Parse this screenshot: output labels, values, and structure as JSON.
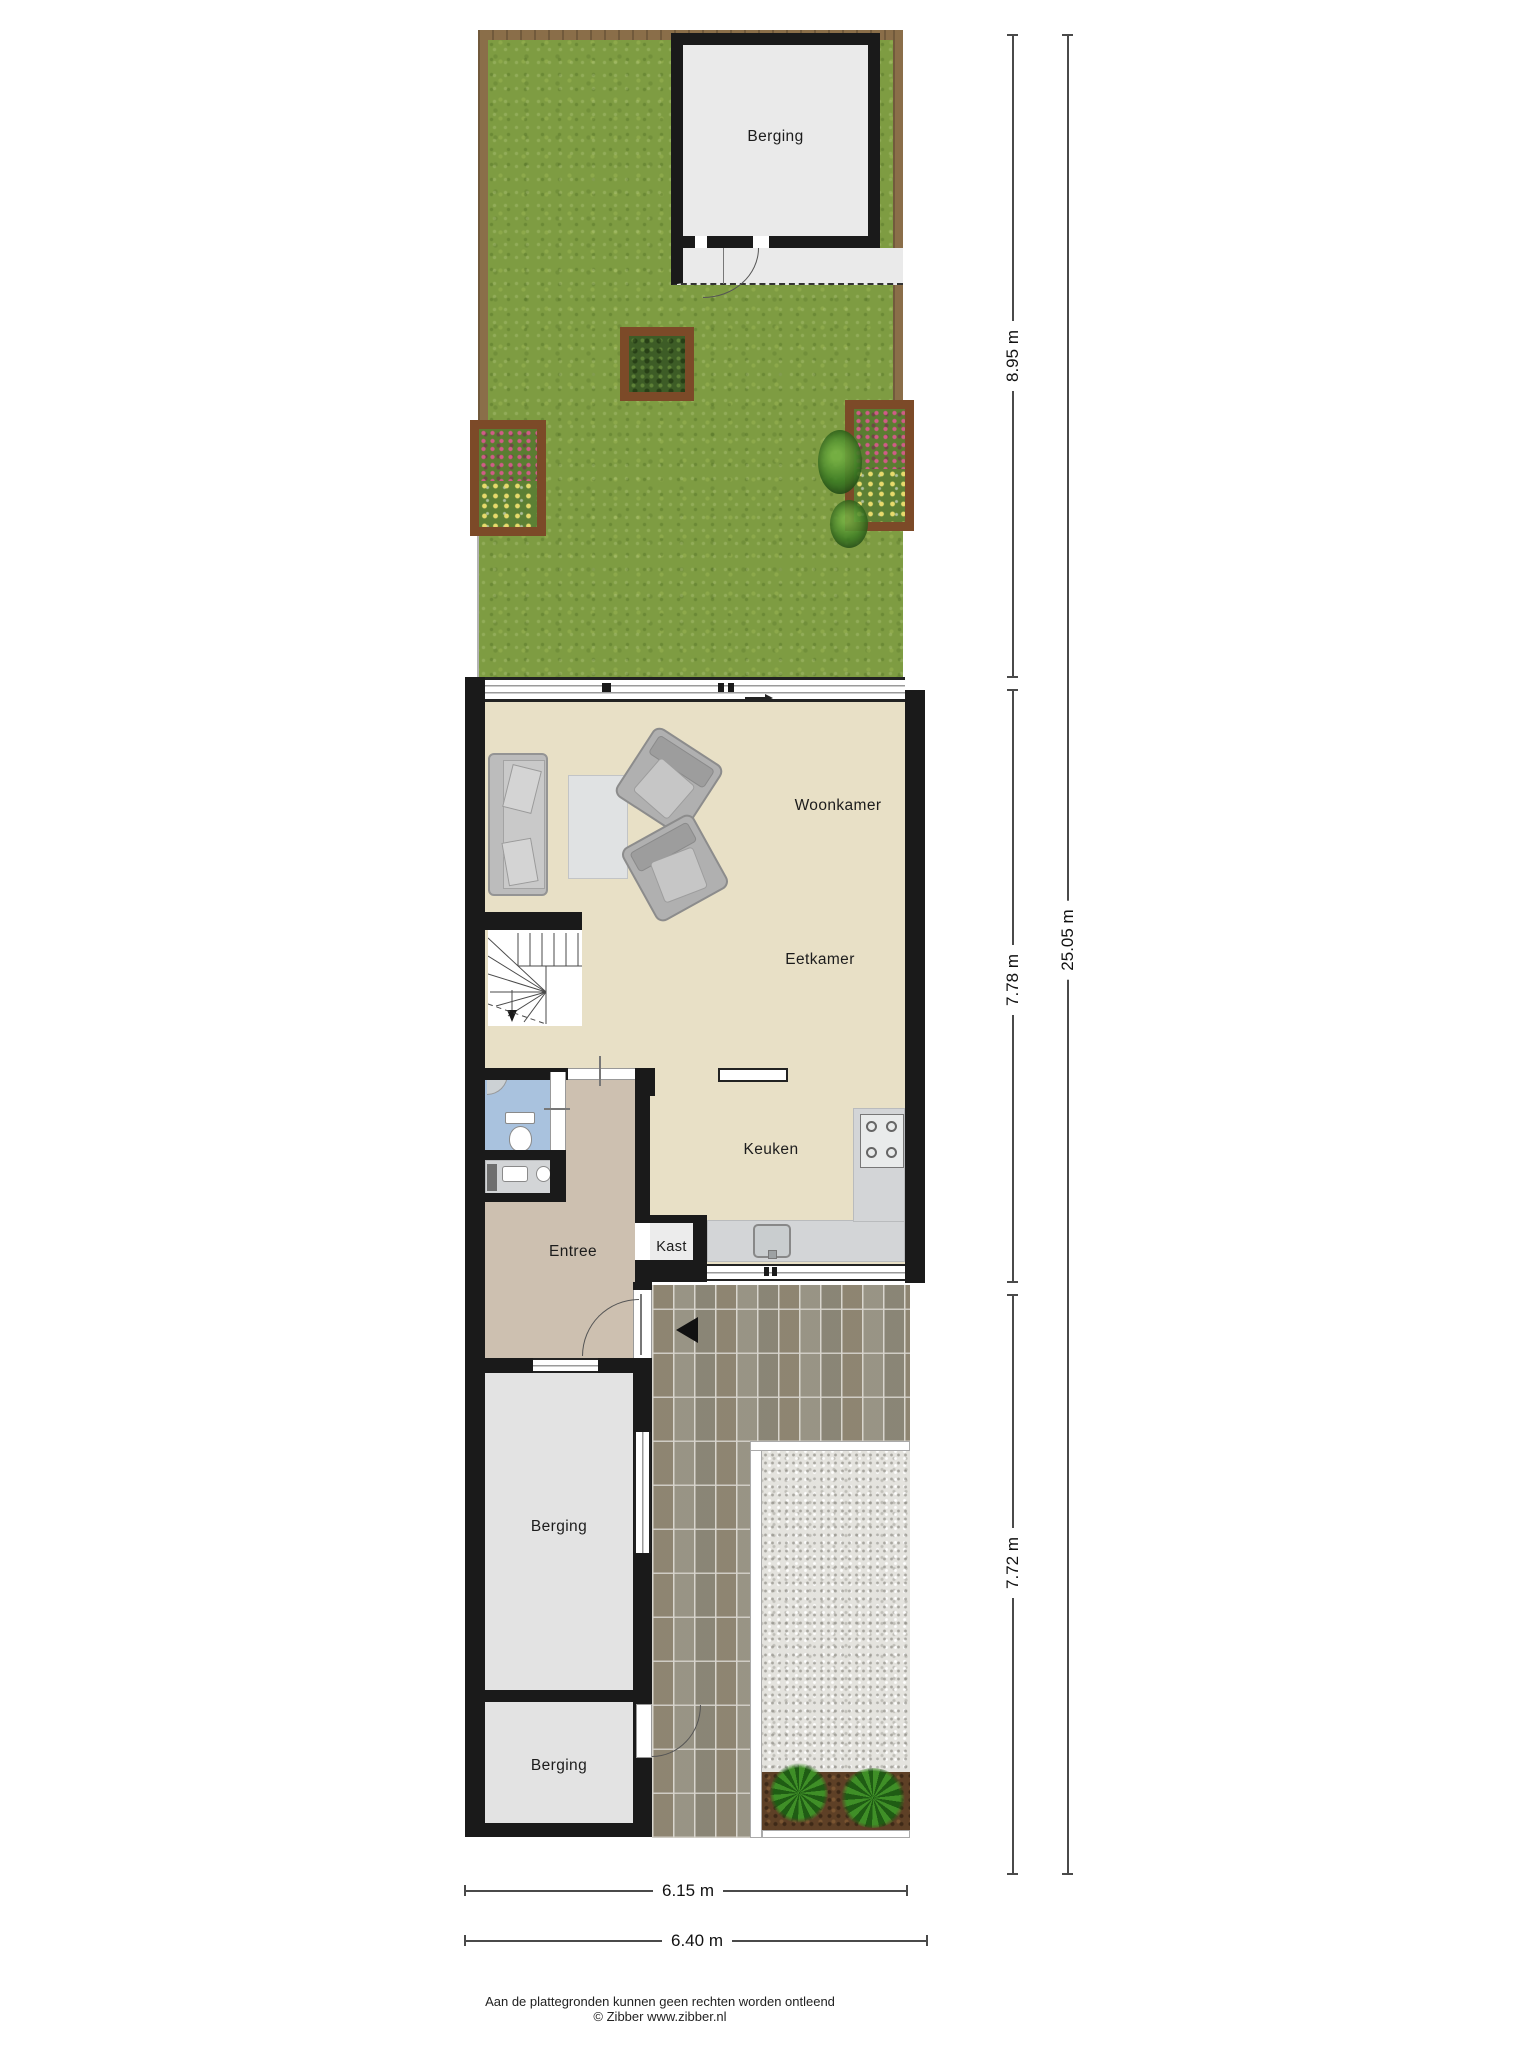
{
  "labels": {
    "garden_shed": "Berging",
    "living_room": "Woonkamer",
    "dining_room": "Eetkamer",
    "kitchen": "Keuken",
    "entry": "Entree",
    "closet": "Kast",
    "storage_1": "Berging",
    "storage_2": "Berging"
  },
  "dimensions": {
    "garden_depth": "8.95 m",
    "main_floor_depth": "7.78 m",
    "rear_section_depth": "7.72 m",
    "total_depth": "25.05 m",
    "building_width": "6.15 m",
    "total_width": "6.40 m"
  },
  "footer": {
    "disclaimer": "Aan de plattegronden kunnen geen rechten worden ontleend",
    "copyright": "© Zibber www.zibber.nl"
  },
  "colors": {
    "wall": "#1a1a1a",
    "grass": "#7e9c42",
    "fence": "#8a6e49",
    "floor_living": "#e8e0c6",
    "floor_entry": "#cdc0b0",
    "floor_toilet": "#a9c2de",
    "floor_storage": "#e3e3e3",
    "kitchen_counter": "#d3d5d7",
    "paving": "#96917f",
    "gravel": "#e4e3de",
    "dimension_line": "#4a4a4a"
  }
}
